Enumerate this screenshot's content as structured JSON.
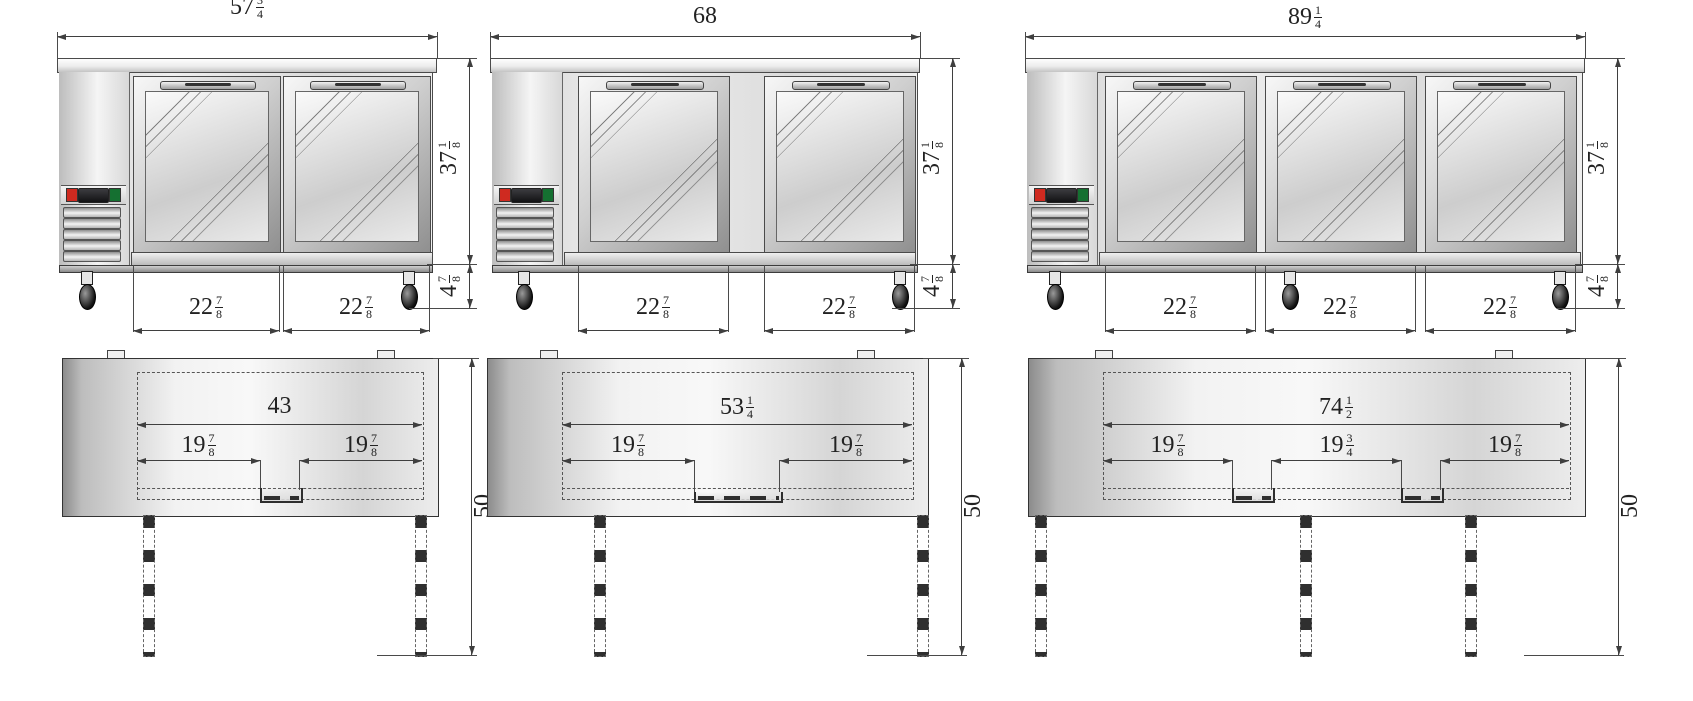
{
  "colors": {
    "line": "#3f3f3f",
    "accent_red_button": "#cf2a20",
    "accent_green_button": "#157031",
    "display_black": "#1a1a1c",
    "metal_light": "#f5f5f5",
    "metal_dark": "#8f8f8f"
  },
  "units": [
    {
      "id": "two-door-back-bar-cooler",
      "front": {
        "overall_width": {
          "whole": "57",
          "num": "3",
          "den": "4"
        },
        "overall_height": {
          "whole": "37",
          "num": "1",
          "den": "8"
        },
        "base_height": {
          "whole": "4",
          "num": "7",
          "den": "8"
        },
        "door_widths": [
          {
            "whole": "22",
            "num": "7",
            "den": "8"
          },
          {
            "whole": "22",
            "num": "7",
            "den": "8"
          }
        ]
      },
      "plan": {
        "opening_width": {
          "whole": "43"
        },
        "door_spans": [
          {
            "whole": "19",
            "num": "7",
            "den": "8"
          },
          {
            "whole": "19",
            "num": "7",
            "den": "8"
          }
        ],
        "overall_depth": {
          "whole": "50"
        }
      }
    },
    {
      "id": "two-door-back-bar-cooler-wide",
      "front": {
        "overall_width": {
          "whole": "68"
        },
        "overall_height": {
          "whole": "37",
          "num": "1",
          "den": "8"
        },
        "base_height": {
          "whole": "4",
          "num": "7",
          "den": "8"
        },
        "door_widths": [
          {
            "whole": "22",
            "num": "7",
            "den": "8"
          },
          {
            "whole": "22",
            "num": "7",
            "den": "8"
          }
        ]
      },
      "plan": {
        "opening_width": {
          "whole": "53",
          "num": "1",
          "den": "4"
        },
        "door_spans": [
          {
            "whole": "19",
            "num": "7",
            "den": "8"
          },
          {
            "whole": "19",
            "num": "7",
            "den": "8"
          }
        ],
        "overall_depth": {
          "whole": "50"
        }
      }
    },
    {
      "id": "three-door-back-bar-cooler",
      "front": {
        "overall_width": {
          "whole": "89",
          "num": "1",
          "den": "4"
        },
        "overall_height": {
          "whole": "37",
          "num": "1",
          "den": "8"
        },
        "base_height": {
          "whole": "4",
          "num": "7",
          "den": "8"
        },
        "door_widths": [
          {
            "whole": "22",
            "num": "7",
            "den": "8"
          },
          {
            "whole": "22",
            "num": "7",
            "den": "8"
          },
          {
            "whole": "22",
            "num": "7",
            "den": "8"
          }
        ]
      },
      "plan": {
        "opening_width": {
          "whole": "74",
          "num": "1",
          "den": "2"
        },
        "door_spans": [
          {
            "whole": "19",
            "num": "7",
            "den": "8"
          },
          {
            "whole": "19",
            "num": "3",
            "den": "4"
          },
          {
            "whole": "19",
            "num": "7",
            "den": "8"
          }
        ],
        "overall_depth": {
          "whole": "50"
        }
      }
    }
  ]
}
